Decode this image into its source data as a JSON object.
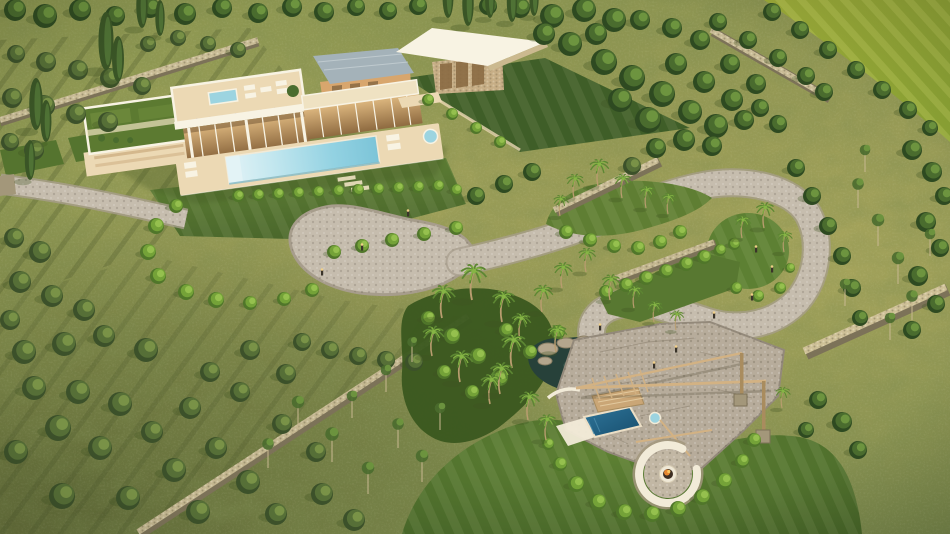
{
  "scene": {
    "title": "Aerial golden-hour 3D render of a Mediterranean luxury villa estate with infinity pool, serpentine cobblestone path, dry-stone walls, olive grove, palm garden and sunken fire-pit lounge",
    "time_of_day": "golden hour",
    "view": "aerial three-quarter",
    "features": [
      "modern flat-roof villa with glass facade",
      "infinity swimming pool with sun loungers",
      "rooftop terrace with spa and lavender planters",
      "guest pavilion with angled white roof",
      "stucco outbuilding with slate roof",
      "cobblestone driveway and motor court",
      "serpentine cobblestone path with loop",
      "dry-stone boundary walls",
      "olive grove with mowing rows",
      "palm garden and natural rock pond",
      "outdoor lounge with plunge pool and pergola",
      "sunken circular fire pit with curved white bench",
      "manicured dark-green lawns",
      "bright farm field in top-right corner"
    ]
  },
  "palette": {
    "grass_base": "#8a9150",
    "grass_gold": "#b3ab61",
    "grass_dark": "#75854a",
    "lawn_dark": "#46622a",
    "lawn_mid": "#5f7e33",
    "lawn_light": "#74943c",
    "field": "#97a636",
    "fol_dark": "#2e4a21",
    "fol_mid": "#4a6c2e",
    "fol_light": "#6f9740",
    "fol_olive_dark": "#3c512a",
    "fol_olive": "#566f37",
    "fol_olive_light": "#7b9348",
    "shrub_dark": "#50762a",
    "shrub_mid": "#74a238",
    "shrub_light": "#97c24f",
    "cypress": "#3a5526",
    "cypress_hi": "#55793a",
    "palm_frond": "#5d8733",
    "palm_frond_hi": "#86b545",
    "palm_trunk": "#b99d6f",
    "stone_path": "#c6bdae",
    "stone_path_dk": "#a79d8c",
    "cobble": "#b7ac9b",
    "cobble_joint": "#93897a",
    "wall_top": "#d7c9a2",
    "wall_face": "#a3977a",
    "wall_dark": "#7c7258",
    "villa_white": "#f8f3e3",
    "villa_cream": "#efe2c2",
    "deck": "#ecd9b4",
    "glass_warm": "#c2955b",
    "glass_dark": "#8a6a43",
    "stucco": "#d8a66d",
    "roof_slate": "#a4b2b9",
    "green_roof": "#5c7a31",
    "pool_shallow": "#e3f3f6",
    "pool_mid": "#a5dbe7",
    "pool_deep": "#7cc8da",
    "spa": "#9cd4e0",
    "plunge": "#2a6d8e",
    "plunge_deep": "#174e6d",
    "pond": "#27413a",
    "wood": "#d3b283",
    "wood_dark": "#a98c5e",
    "bench_white": "#f2ebd8",
    "fire": "#e6862f",
    "flame_hi": "#f8c45e",
    "rock": "#b4a68d",
    "rock_dark": "#8a7e64",
    "shadow": "#3f5222",
    "lavender": "#9a8fb8"
  },
  "vegetation": {
    "trees": [
      [
        15,
        10,
        11,
        "l"
      ],
      [
        45,
        16,
        12,
        "l"
      ],
      [
        80,
        10,
        11,
        "l"
      ],
      [
        115,
        16,
        10,
        "l"
      ],
      [
        150,
        8,
        10,
        "l"
      ],
      [
        185,
        14,
        11,
        "l"
      ],
      [
        222,
        8,
        10,
        "l"
      ],
      [
        258,
        13,
        10,
        "l"
      ],
      [
        292,
        7,
        10,
        "l"
      ],
      [
        324,
        12,
        10,
        "l"
      ],
      [
        356,
        7,
        9,
        "l"
      ],
      [
        388,
        11,
        9,
        "l"
      ],
      [
        418,
        6,
        9,
        "l"
      ],
      [
        488,
        6,
        9,
        "l"
      ],
      [
        520,
        8,
        10,
        "l"
      ],
      [
        552,
        16,
        12,
        "l"
      ],
      [
        584,
        10,
        12,
        "l"
      ],
      [
        614,
        20,
        12,
        "l"
      ],
      [
        596,
        34,
        11,
        "l"
      ],
      [
        570,
        44,
        12,
        "l"
      ],
      [
        544,
        34,
        11,
        "l"
      ],
      [
        604,
        62,
        13,
        "l"
      ],
      [
        632,
        78,
        13,
        "l"
      ],
      [
        662,
        94,
        13,
        "l"
      ],
      [
        690,
        112,
        12,
        "l"
      ],
      [
        716,
        126,
        12,
        "l"
      ],
      [
        648,
        120,
        13,
        "l"
      ],
      [
        620,
        100,
        12,
        "l"
      ],
      [
        676,
        64,
        11,
        "l"
      ],
      [
        704,
        82,
        11,
        "l"
      ],
      [
        732,
        100,
        11,
        "l"
      ],
      [
        744,
        120,
        10,
        "l"
      ],
      [
        712,
        146,
        10,
        "l"
      ],
      [
        684,
        140,
        11,
        "l"
      ],
      [
        656,
        148,
        10,
        "l"
      ],
      [
        730,
        64,
        10,
        "l"
      ],
      [
        756,
        84,
        10,
        "l"
      ],
      [
        700,
        40,
        10,
        "l"
      ],
      [
        672,
        28,
        10,
        "l"
      ],
      [
        640,
        20,
        10,
        "l"
      ],
      [
        760,
        108,
        9,
        "l"
      ],
      [
        778,
        124,
        9,
        "l"
      ],
      [
        772,
        12,
        9,
        "l"
      ],
      [
        800,
        30,
        9,
        "l"
      ],
      [
        828,
        50,
        9,
        "l"
      ],
      [
        856,
        70,
        9,
        "l"
      ],
      [
        882,
        90,
        9,
        "l"
      ],
      [
        908,
        110,
        9,
        "l"
      ],
      [
        930,
        128,
        8,
        "l"
      ],
      [
        718,
        22,
        9,
        "l"
      ],
      [
        748,
        40,
        9,
        "l"
      ],
      [
        778,
        58,
        9,
        "l"
      ],
      [
        806,
        76,
        9,
        "l"
      ],
      [
        824,
        92,
        9,
        "l"
      ],
      [
        796,
        168,
        9,
        "l"
      ],
      [
        812,
        196,
        9,
        "l"
      ],
      [
        828,
        226,
        9,
        "l"
      ],
      [
        842,
        256,
        9,
        "l"
      ],
      [
        852,
        288,
        9,
        "l"
      ],
      [
        860,
        318,
        8,
        "l"
      ],
      [
        912,
        150,
        10,
        "l"
      ],
      [
        932,
        172,
        10,
        "l"
      ],
      [
        944,
        196,
        9,
        "l"
      ],
      [
        926,
        222,
        10,
        "l"
      ],
      [
        940,
        248,
        9,
        "l"
      ],
      [
        918,
        276,
        10,
        "l"
      ],
      [
        936,
        304,
        9,
        "l"
      ],
      [
        912,
        330,
        9,
        "l"
      ],
      [
        16,
        54,
        9,
        "o"
      ],
      [
        46,
        62,
        10,
        "o"
      ],
      [
        78,
        70,
        10,
        "o"
      ],
      [
        110,
        78,
        10,
        "o"
      ],
      [
        142,
        86,
        9,
        "o"
      ],
      [
        12,
        98,
        10,
        "o"
      ],
      [
        44,
        106,
        11,
        "o"
      ],
      [
        76,
        114,
        10,
        "o"
      ],
      [
        108,
        122,
        10,
        "o"
      ],
      [
        10,
        142,
        9,
        "o"
      ],
      [
        34,
        150,
        10,
        "o"
      ],
      [
        148,
        44,
        8,
        "o"
      ],
      [
        178,
        38,
        8,
        "o"
      ],
      [
        208,
        44,
        8,
        "o"
      ],
      [
        238,
        50,
        8,
        "o"
      ],
      [
        14,
        238,
        10,
        "o"
      ],
      [
        40,
        252,
        11,
        "o"
      ],
      [
        20,
        282,
        11,
        "o"
      ],
      [
        52,
        296,
        11,
        "o"
      ],
      [
        84,
        310,
        11,
        "o"
      ],
      [
        10,
        320,
        10,
        "o"
      ],
      [
        24,
        352,
        12,
        "o"
      ],
      [
        64,
        344,
        12,
        "o"
      ],
      [
        104,
        336,
        11,
        "o"
      ],
      [
        146,
        350,
        12,
        "o"
      ],
      [
        34,
        388,
        12,
        "o"
      ],
      [
        78,
        392,
        12,
        "o"
      ],
      [
        120,
        404,
        12,
        "o"
      ],
      [
        58,
        428,
        13,
        "o"
      ],
      [
        16,
        452,
        12,
        "o"
      ],
      [
        100,
        448,
        12,
        "o"
      ],
      [
        152,
        432,
        11,
        "o"
      ],
      [
        190,
        408,
        11,
        "o"
      ],
      [
        174,
        470,
        12,
        "o"
      ],
      [
        216,
        448,
        11,
        "o"
      ],
      [
        248,
        482,
        12,
        "o"
      ],
      [
        128,
        498,
        12,
        "o"
      ],
      [
        62,
        496,
        13,
        "o"
      ],
      [
        198,
        512,
        12,
        "o"
      ],
      [
        276,
        514,
        11,
        "o"
      ],
      [
        240,
        392,
        10,
        "o"
      ],
      [
        282,
        424,
        10,
        "o"
      ],
      [
        316,
        452,
        10,
        "o"
      ],
      [
        322,
        494,
        11,
        "o"
      ],
      [
        354,
        520,
        11,
        "o"
      ],
      [
        210,
        372,
        10,
        "o"
      ],
      [
        250,
        350,
        10,
        "o"
      ],
      [
        286,
        374,
        10,
        "o"
      ],
      [
        302,
        342,
        9,
        "o"
      ],
      [
        330,
        350,
        9,
        "o"
      ],
      [
        358,
        356,
        9,
        "o"
      ],
      [
        386,
        360,
        9,
        "o"
      ],
      [
        414,
        362,
        9,
        "o"
      ],
      [
        476,
        196,
        9,
        "l"
      ],
      [
        504,
        184,
        9,
        "l"
      ],
      [
        532,
        172,
        9,
        "l"
      ],
      [
        632,
        166,
        9,
        "o"
      ],
      [
        818,
        400,
        9,
        "l"
      ],
      [
        842,
        422,
        10,
        "l"
      ],
      [
        858,
        450,
        9,
        "l"
      ],
      [
        806,
        430,
        8,
        "l"
      ]
    ],
    "shrubs": [
      [
        176,
        206,
        7,
        "s"
      ],
      [
        156,
        226,
        8,
        "s"
      ],
      [
        148,
        252,
        8,
        "s"
      ],
      [
        158,
        276,
        8,
        "s"
      ],
      [
        186,
        292,
        8,
        "s"
      ],
      [
        216,
        300,
        8,
        "s"
      ],
      [
        250,
        303,
        7,
        "s"
      ],
      [
        284,
        299,
        7,
        "s"
      ],
      [
        312,
        290,
        7,
        "s"
      ],
      [
        334,
        252,
        7,
        "s"
      ],
      [
        362,
        246,
        7,
        "s"
      ],
      [
        392,
        240,
        7,
        "s"
      ],
      [
        424,
        234,
        7,
        "s"
      ],
      [
        456,
        228,
        7,
        "s"
      ],
      [
        238,
        196,
        6,
        "h"
      ],
      [
        258,
        195,
        6,
        "h"
      ],
      [
        278,
        194,
        6,
        "h"
      ],
      [
        298,
        193,
        6,
        "h"
      ],
      [
        318,
        192,
        6,
        "h"
      ],
      [
        338,
        191,
        6,
        "h"
      ],
      [
        358,
        190,
        6,
        "h"
      ],
      [
        378,
        189,
        6,
        "h"
      ],
      [
        398,
        188,
        6,
        "h"
      ],
      [
        418,
        187,
        6,
        "h"
      ],
      [
        438,
        186,
        6,
        "h"
      ],
      [
        456,
        190,
        6,
        "h"
      ],
      [
        566,
        232,
        7,
        "s"
      ],
      [
        590,
        240,
        7,
        "s"
      ],
      [
        614,
        246,
        7,
        "s"
      ],
      [
        638,
        248,
        7,
        "s"
      ],
      [
        660,
        242,
        7,
        "s"
      ],
      [
        680,
        232,
        7,
        "s"
      ],
      [
        606,
        292,
        7,
        "h"
      ],
      [
        626,
        285,
        7,
        "h"
      ],
      [
        646,
        278,
        7,
        "h"
      ],
      [
        666,
        271,
        7,
        "h"
      ],
      [
        686,
        264,
        7,
        "h"
      ],
      [
        704,
        257,
        7,
        "h"
      ],
      [
        720,
        250,
        6,
        "h"
      ],
      [
        734,
        244,
        6,
        "h"
      ],
      [
        736,
        288,
        6,
        "s"
      ],
      [
        758,
        296,
        6,
        "s"
      ],
      [
        780,
        288,
        6,
        "s"
      ],
      [
        790,
        268,
        5,
        "s"
      ],
      [
        560,
        464,
        7,
        "h"
      ],
      [
        576,
        484,
        8,
        "h"
      ],
      [
        598,
        502,
        8,
        "h"
      ],
      [
        624,
        512,
        8,
        "h"
      ],
      [
        652,
        514,
        8,
        "h"
      ],
      [
        678,
        509,
        8,
        "h"
      ],
      [
        702,
        497,
        8,
        "h"
      ],
      [
        724,
        481,
        8,
        "h"
      ],
      [
        742,
        461,
        7,
        "h"
      ],
      [
        754,
        440,
        7,
        "h"
      ],
      [
        548,
        444,
        6,
        "h"
      ],
      [
        428,
        100,
        6,
        "s"
      ],
      [
        452,
        114,
        6,
        "s"
      ],
      [
        476,
        128,
        6,
        "s"
      ],
      [
        500,
        142,
        6,
        "s"
      ],
      [
        428,
        318,
        7,
        "s"
      ],
      [
        452,
        336,
        8,
        "s"
      ],
      [
        478,
        356,
        8,
        "s"
      ],
      [
        500,
        378,
        8,
        "s"
      ],
      [
        472,
        392,
        7,
        "s"
      ],
      [
        444,
        372,
        7,
        "s"
      ],
      [
        506,
        330,
        7,
        "s"
      ],
      [
        530,
        352,
        7,
        "s"
      ],
      [
        558,
        332,
        7,
        "s"
      ]
    ],
    "palms": [
      [
        574,
        198,
        0.8
      ],
      [
        598,
        186,
        0.9
      ],
      [
        622,
        198,
        0.8
      ],
      [
        646,
        208,
        0.75
      ],
      [
        668,
        214,
        0.7
      ],
      [
        560,
        216,
        0.7
      ],
      [
        742,
        238,
        0.75
      ],
      [
        764,
        228,
        0.85
      ],
      [
        784,
        252,
        0.7
      ],
      [
        442,
        318,
        1.1
      ],
      [
        472,
        300,
        1.2
      ],
      [
        502,
        322,
        1.05
      ],
      [
        432,
        356,
        1.0
      ],
      [
        460,
        382,
        1.05
      ],
      [
        490,
        404,
        1.0
      ],
      [
        520,
        340,
        0.9
      ],
      [
        542,
        312,
        0.9
      ],
      [
        562,
        288,
        0.85
      ],
      [
        586,
        272,
        0.8
      ],
      [
        610,
        300,
        0.85
      ],
      [
        634,
        308,
        0.75
      ],
      [
        512,
        368,
        1.15
      ],
      [
        500,
        394,
        1.05
      ],
      [
        528,
        420,
        0.95
      ],
      [
        546,
        440,
        0.85
      ],
      [
        556,
        352,
        0.9
      ],
      [
        654,
        322,
        0.7
      ],
      [
        676,
        330,
        0.65
      ],
      [
        782,
        408,
        0.7
      ]
    ],
    "cypresses": [
      [
        36,
        130,
        52
      ],
      [
        46,
        142,
        42
      ],
      [
        106,
        70,
        58
      ],
      [
        118,
        82,
        46
      ],
      [
        142,
        28,
        44
      ],
      [
        160,
        36,
        36
      ],
      [
        448,
        18,
        42
      ],
      [
        468,
        26,
        44
      ],
      [
        490,
        18,
        38
      ],
      [
        512,
        22,
        40
      ],
      [
        534,
        16,
        36
      ],
      [
        30,
        180,
        40
      ]
    ],
    "saplings": [
      [
        298,
        428,
        26
      ],
      [
        332,
        462,
        28
      ],
      [
        368,
        494,
        26
      ],
      [
        398,
        448,
        24
      ],
      [
        422,
        482,
        26
      ],
      [
        268,
        468,
        24
      ],
      [
        352,
        418,
        22
      ],
      [
        386,
        392,
        22
      ],
      [
        412,
        362,
        20
      ],
      [
        440,
        430,
        22
      ],
      [
        858,
        208,
        24
      ],
      [
        878,
        246,
        26
      ],
      [
        898,
        284,
        26
      ],
      [
        845,
        306,
        22
      ],
      [
        912,
        320,
        24
      ],
      [
        865,
        172,
        22
      ],
      [
        930,
        256,
        22
      ],
      [
        890,
        340,
        22
      ]
    ],
    "bollards": [
      [
        408,
        216
      ],
      [
        362,
        250
      ],
      [
        322,
        275
      ],
      [
        756,
        252
      ],
      [
        772,
        272
      ],
      [
        752,
        300
      ],
      [
        714,
        318
      ],
      [
        654,
        368
      ],
      [
        600,
        330
      ],
      [
        676,
        352
      ]
    ],
    "pond_rocks": [
      [
        548,
        349,
        10,
        6
      ],
      [
        566,
        343,
        9,
        5
      ],
      [
        584,
        341,
        8,
        5
      ],
      [
        602,
        345,
        9,
        5
      ],
      [
        619,
        351,
        8,
        5
      ],
      [
        634,
        359,
        8,
        5
      ],
      [
        643,
        371,
        9,
        6
      ],
      [
        630,
        384,
        8,
        5
      ],
      [
        545,
        361,
        7,
        4
      ],
      [
        610,
        338,
        6,
        4
      ]
    ]
  }
}
